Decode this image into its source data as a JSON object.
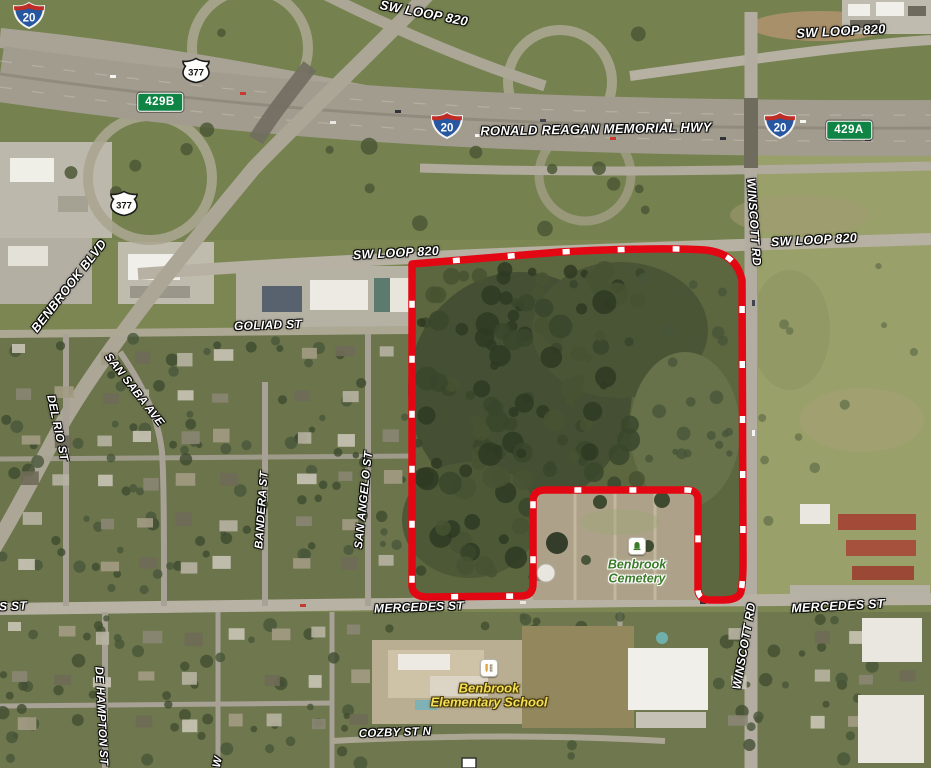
{
  "map": {
    "description": "Aerial satellite map of Benbrook TX with red property boundary outline",
    "boundary": {
      "color": "#e30613",
      "dash_color": "#ffffff"
    },
    "road_labels": [
      {
        "id": "sw-loop-820-top",
        "text": "SW LOOP 820",
        "x": 424,
        "y": 13,
        "rot": 11,
        "size": 13
      },
      {
        "id": "sw-loop-820-top-right",
        "text": "SW LOOP 820",
        "x": 841,
        "y": 31,
        "rot": -3,
        "size": 13
      },
      {
        "id": "ronald-reagan-memorial-hwy",
        "text": "RONALD REAGAN MEMORIAL HWY",
        "x": 596,
        "y": 129,
        "rot": -1,
        "size": 13
      },
      {
        "id": "sw-loop-820-mid",
        "text": "SW LOOP 820",
        "x": 396,
        "y": 253,
        "rot": -3,
        "size": 12.5
      },
      {
        "id": "sw-loop-820-right",
        "text": "SW LOOP 820",
        "x": 814,
        "y": 240,
        "rot": -3,
        "size": 12.5
      },
      {
        "id": "goliad-st",
        "text": "GOLIAD ST",
        "x": 268,
        "y": 325,
        "rot": -2,
        "size": 12
      },
      {
        "id": "benbrook-blvd",
        "text": "BENBROOK BLVD",
        "x": 69,
        "y": 286,
        "rot": -52,
        "size": 12.5
      },
      {
        "id": "san-saba-ave",
        "text": "SAN SABA AVE",
        "x": 134,
        "y": 390,
        "rot": 52,
        "size": 11.5
      },
      {
        "id": "del-rio-st",
        "text": "DEL RIO ST",
        "x": 57,
        "y": 428,
        "rot": 78,
        "size": 11.5
      },
      {
        "id": "bandera-st",
        "text": "BANDERA ST",
        "x": 262,
        "y": 510,
        "rot": -86,
        "size": 11.5
      },
      {
        "id": "san-angelo-st",
        "text": "SAN ANGELO ST",
        "x": 364,
        "y": 500,
        "rot": -84,
        "size": 11.5
      },
      {
        "id": "winscott-rd-north",
        "text": "WINSCOTT RD",
        "x": 754,
        "y": 222,
        "rot": 86,
        "size": 12
      },
      {
        "id": "winscott-rd-south",
        "text": "WINSCOTT RD",
        "x": 744,
        "y": 646,
        "rot": -80,
        "size": 12
      },
      {
        "id": "mercedes-st-west-fragment",
        "text": "S ST",
        "x": 13,
        "y": 606,
        "rot": -2,
        "size": 12
      },
      {
        "id": "mercedes-st-center",
        "text": "MERCEDES ST",
        "x": 419,
        "y": 607,
        "rot": -2,
        "size": 12
      },
      {
        "id": "mercedes-st-east",
        "text": "MERCEDES ST",
        "x": 838,
        "y": 606,
        "rot": -3,
        "size": 12.5
      },
      {
        "id": "cozby-st-n",
        "text": "COZBY ST N",
        "x": 395,
        "y": 733,
        "rot": -2,
        "size": 11.5
      },
      {
        "id": "de-hampton-st",
        "text": "DE HAMPTON ST",
        "x": 101,
        "y": 716,
        "rot": 87,
        "size": 11.5
      },
      {
        "id": "street-fragment-w",
        "text": "W",
        "x": 218,
        "y": 762,
        "rot": -78,
        "size": 11.5
      }
    ],
    "shields": [
      {
        "id": "i20-shield-top-left",
        "type": "interstate",
        "text": "20",
        "x": 29,
        "y": 18
      },
      {
        "id": "i20-shield-center",
        "type": "interstate",
        "text": "20",
        "x": 447,
        "y": 128
      },
      {
        "id": "i20-shield-right",
        "type": "interstate",
        "text": "20",
        "x": 780,
        "y": 128
      },
      {
        "id": "us377-shield-north",
        "type": "us-route",
        "text": "377",
        "x": 196,
        "y": 73
      },
      {
        "id": "us377-shield-south",
        "type": "us-route",
        "text": "377",
        "x": 124,
        "y": 206
      },
      {
        "id": "exit-sign-429b",
        "type": "exit",
        "text": "429B",
        "x": 160,
        "y": 102
      },
      {
        "id": "exit-sign-429a",
        "type": "exit",
        "text": "429A",
        "x": 849,
        "y": 130
      }
    ],
    "pois": [
      {
        "id": "benbrook-cemetery",
        "lines": [
          "Benbrook",
          "Cemetery"
        ],
        "icon": "cemetery-icon",
        "style": "poi-cemetery",
        "x": 637,
        "y": 572,
        "icon_y": 546,
        "size": 12.5
      },
      {
        "id": "benbrook-elementary-school",
        "lines": [
          "Benbrook",
          "Elementary School"
        ],
        "icon": "school-icon",
        "style": "poi-school",
        "x": 489,
        "y": 696,
        "icon_y": 668,
        "size": 13
      }
    ]
  }
}
